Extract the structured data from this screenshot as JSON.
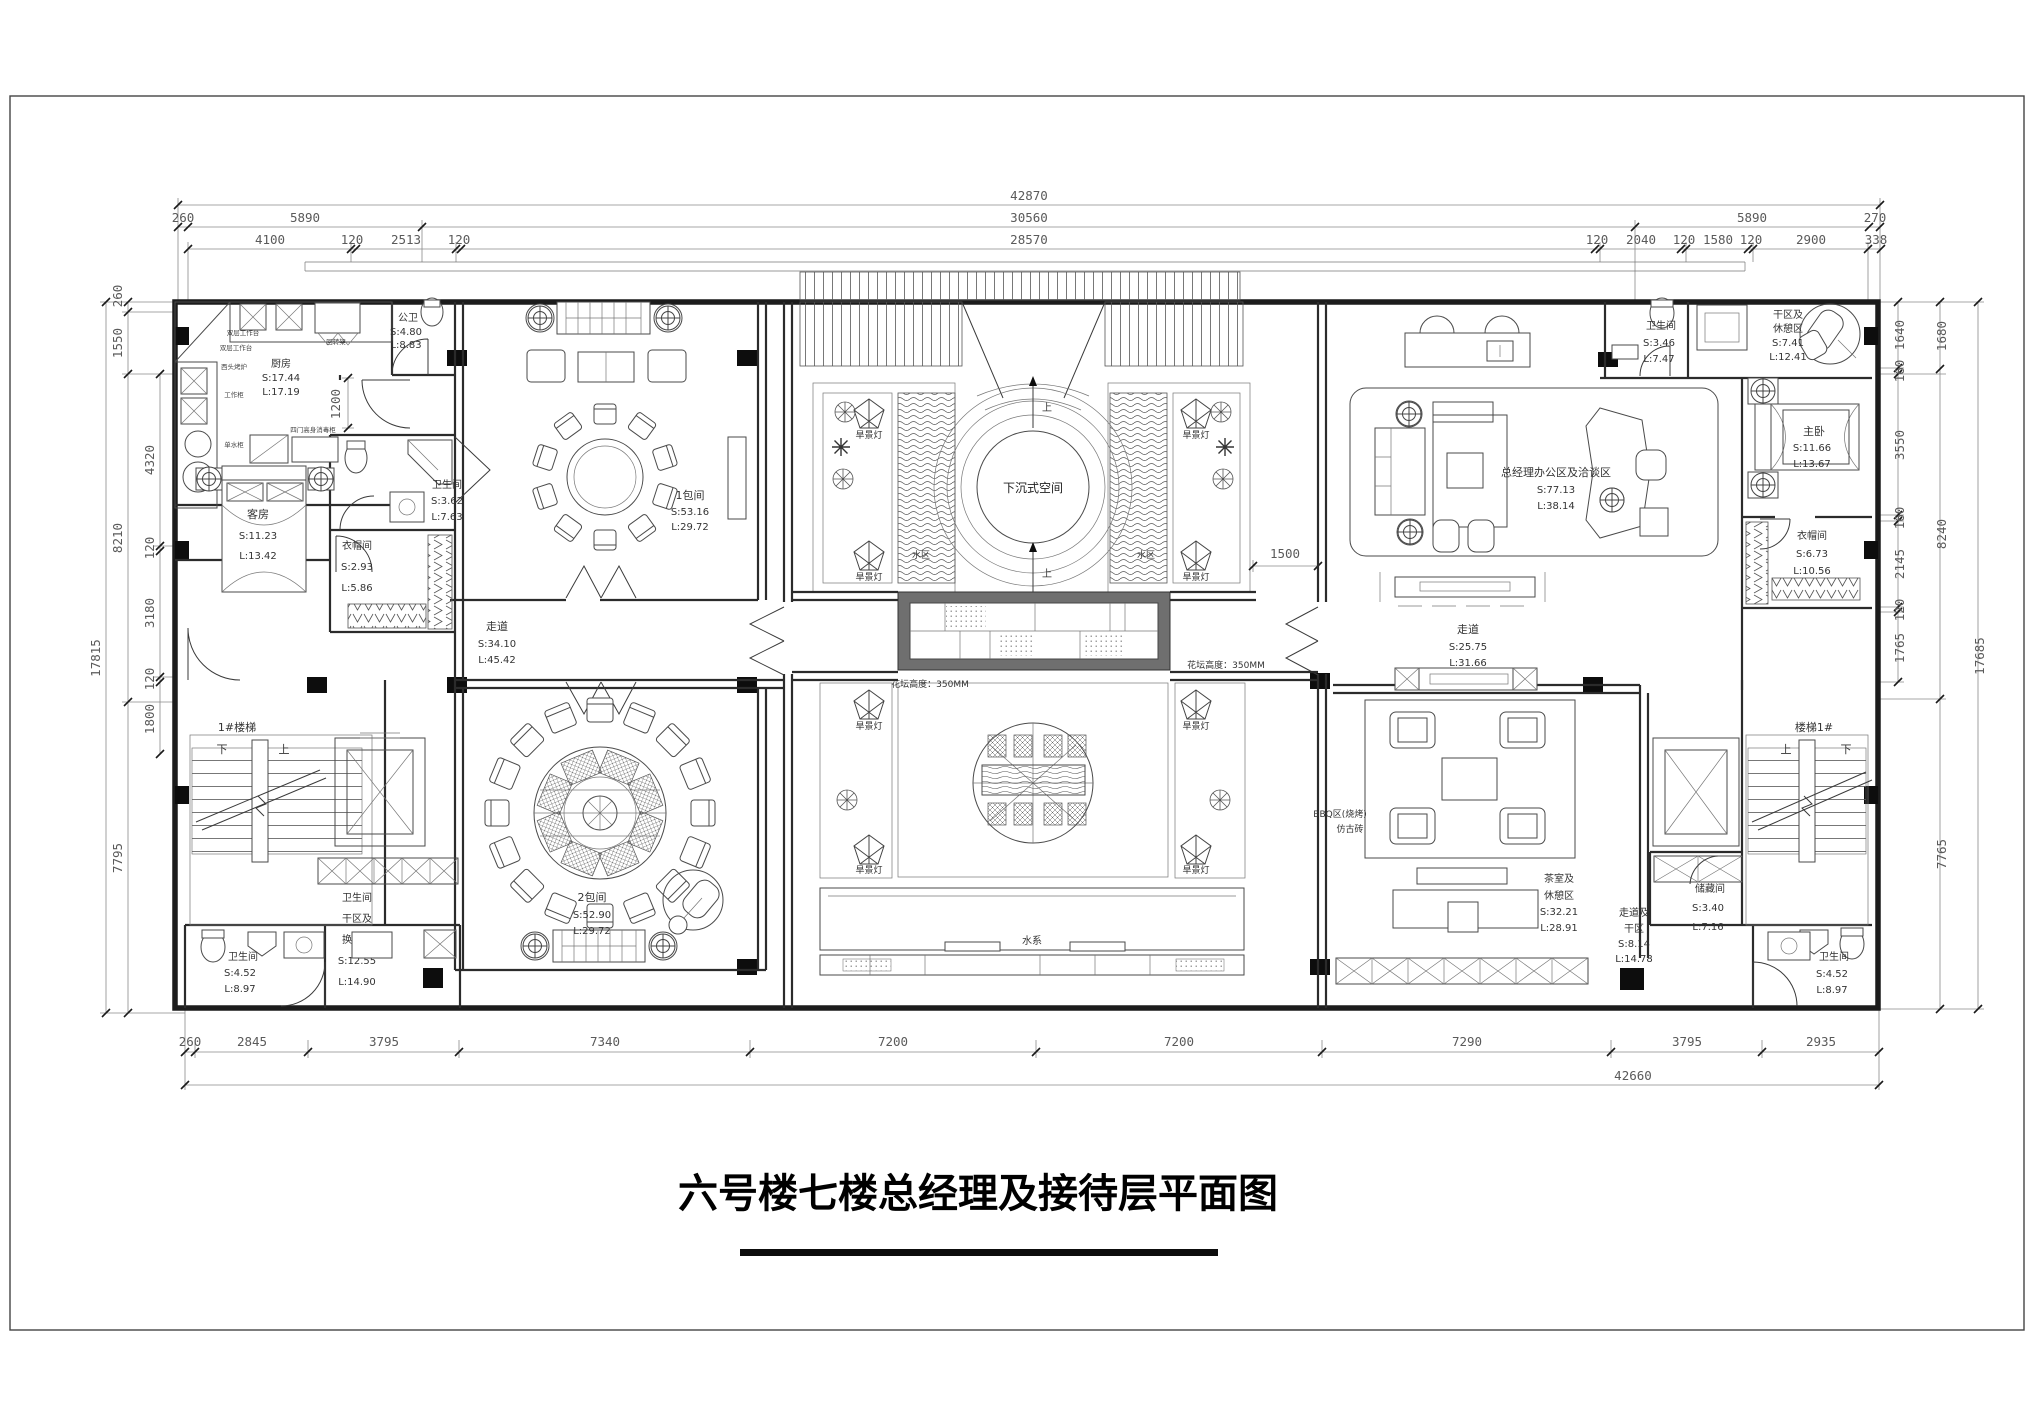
{
  "title": "六号楼七楼总经理及接待层平面图",
  "dims": {
    "top_total": "42870",
    "top_mid": [
      "260",
      "5890",
      "30560",
      "5890",
      "270"
    ],
    "top_inner": [
      "4100",
      "120",
      "2513",
      "120",
      "28570",
      "120",
      "2040",
      "120",
      "1580",
      "120",
      "2900",
      "338"
    ],
    "bottom": [
      "260",
      "2845",
      "3795",
      "7340",
      "7200",
      "7200",
      "7290",
      "3795",
      "2935"
    ],
    "bottom_total": "42660",
    "left_outer": "17815",
    "left_mid": [
      "260",
      "1550",
      "8210",
      "7795"
    ],
    "left_inner": [
      "4320",
      "120",
      "3180",
      "120",
      "1800"
    ],
    "right_outer": "17685",
    "right_mid": [
      "1680",
      "8240",
      "7765"
    ],
    "right_inner": [
      "1640",
      "160",
      "3550",
      "160",
      "2145",
      "120",
      "1765"
    ],
    "door": "1500",
    "kitchen_niche": "1200"
  },
  "rooms": {
    "kitchen": {
      "name": "厨房",
      "s": "S:17.44",
      "l": "L:17.19"
    },
    "public_wc": {
      "name": "公卫",
      "s": "S:4.80",
      "l": "L:8.83"
    },
    "bath_left": {
      "name": "卫生间",
      "s": "S:3.62",
      "l": "L:7.63"
    },
    "guest": {
      "name": "客房",
      "s": "S:11.23",
      "l": "L:13.42"
    },
    "cloak_left": {
      "name": "衣帽间",
      "s": "S:2.93",
      "l": "L:5.86"
    },
    "dining1": {
      "name": "1包间",
      "s": "S:53.16",
      "l": "L:29.72"
    },
    "corridor_left": {
      "name": "走道",
      "s": "S:34.10",
      "l": "L:45.42"
    },
    "dining2": {
      "name": "2包间",
      "s": "S:52.90",
      "l": "L:29.72"
    },
    "stair1": {
      "name": "1#楼梯"
    },
    "wc_dry_left": {
      "name": "卫生间",
      "line2": "干区及",
      "line3": "换衣区",
      "s": "S:12.55",
      "l": "L:14.90"
    },
    "bath_bl": {
      "name": "卫生间",
      "s": "S:4.52",
      "l": "L:8.97"
    },
    "office": {
      "name": "总经理办公区及洽谈区",
      "s": "S:77.13",
      "l": "L:38.14"
    },
    "corridor_right": {
      "name": "走道",
      "s": "S:25.75",
      "l": "L:31.66"
    },
    "bath_tr": {
      "name": "卫生间",
      "s": "S:3.46",
      "l": "L:7.47"
    },
    "dry_rest": {
      "line1": "干区及",
      "line2": "休憩区",
      "s": "S:7.41",
      "l": "L:12.41"
    },
    "master": {
      "name": "主卧",
      "s": "S:11.66",
      "l": "L:13.67"
    },
    "cloak_right": {
      "name": "衣帽间",
      "s": "S:6.73",
      "l": "L:10.56"
    },
    "tea_room": {
      "line1": "茶室及",
      "line2": "休憩区",
      "s": "S:32.21",
      "l": "L:28.91"
    },
    "corridor_dry": {
      "line1": "走道及",
      "line2": "干区",
      "s": "S:8.14",
      "l": "L:14.78"
    },
    "storage": {
      "name": "储藏间",
      "s": "S:3.40",
      "l": "L:7.16"
    },
    "bath_br": {
      "name": "卫生间",
      "s": "S:4.52",
      "l": "L:8.97"
    },
    "stair2": {
      "name": "楼梯1#"
    },
    "sunken": {
      "name": "下沉式空间"
    },
    "water_sys": {
      "name": "水系"
    },
    "water_zone": {
      "name": "水区"
    },
    "bbq": {
      "line1": "BBQ区(烧烤)",
      "line2": "仿古砖"
    }
  },
  "labels": {
    "lamp": "旱景灯",
    "up": "上",
    "down": "下",
    "planter_h_left": "花坛高度：350MM",
    "planter_h_right": "花坛高度：350MM",
    "kitchen_items": [
      "双层工作台",
      "双层工作台",
      "西头烤炉",
      "回转架",
      "工作柜",
      "单水柜",
      "四门高身消毒柜",
      "双层工作台"
    ]
  }
}
